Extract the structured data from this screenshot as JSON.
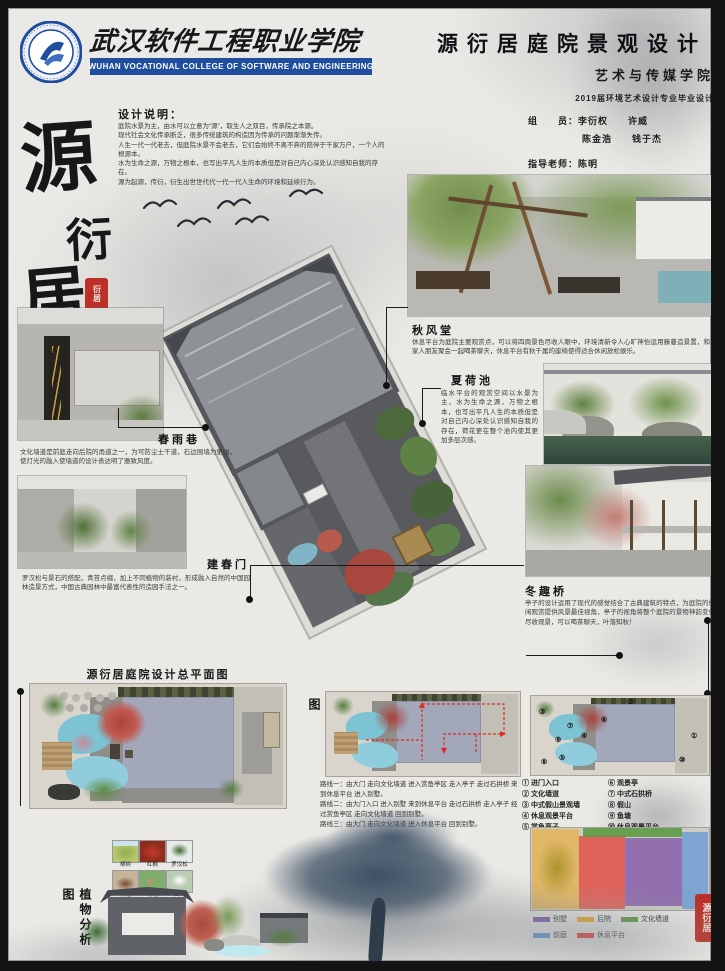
{
  "colors": {
    "brand_blue": "#1f4e9e",
    "seal_red": "#bc3027",
    "paper": "#ebe9e5"
  },
  "header": {
    "college_cn": "武汉软件工程职业学院",
    "college_en": "WUHAN VOCATIONAL COLLEGE OF SOFTWARE AND ENGINEERING",
    "poster_title": "源衍居庭院景观设计",
    "department": "艺术与传媒学院",
    "program": "2019届环境艺术设计专业毕业设计",
    "team_label": "组　　员：",
    "team_row1": "李衍权　　许威",
    "team_row2": "陈金浩　　钱于杰",
    "advisor_label": "指导老师：",
    "advisor_name": "陈明"
  },
  "design_note": {
    "title": "设计说明：",
    "lines": [
      "庭院水景为主，由水可以立意为“源”，取生人之双目，传承院之本源。",
      "现代社会文化传承断乏，很多传统建筑的构造因为传承的问题渐渐失传。",
      "人生一代一代老去，但庭院水景不会老去，它们会始终不离不弃的陪伴于千家万户，一个人的根源本。",
      "水为生命之源，万物之根本，也写出平凡人生的本质但是对自己内心深处认识感知自我的存在。",
      "源为起源，传衍，衍生出世世代代一代一代人生命的环境和延续行为。"
    ]
  },
  "calligraphy": {
    "char1": "源",
    "char2": "衍",
    "char3": "居",
    "seal_text": "衍居"
  },
  "features": [
    {
      "label": "秋风堂",
      "desc": "休息平台为庭院主要观赏点，可以将四周景色尽收人眼中，环境清新令人心旷神怡运用藤蔓造景置，和家人朋友聚会一起喝茶聊天，休息平台有秋千属的座椅使得适合休闲放松娱乐。"
    },
    {
      "label": "夏荷池",
      "desc": "临水平台的观赏空间以水景为主，水为生命之源，万物之根本，也写出平凡人生的本质但是对自己内心深处认识感知自我的存在，荷花更在整个池内使其更加多层次感。"
    },
    {
      "label": "春雨巷",
      "desc": "文化墙道是前庭走向后院的甬道之一，为可防尘土干道，石边围墙为更幽，使灯光的融入使墙道的设计表达明了雅致风度。"
    },
    {
      "label": "建春门",
      "desc": "罗汉松与景石的搭配，青苔点缀，加上不同植物的装衬，形成融入自然的中国园林造景方式，中国古典园林中最富代表性的造园手法之一。"
    },
    {
      "label": "冬趣桥",
      "desc": "亭子的设计运用了现代的感觉结合了古典建筑的特点，为庭院的休闲观赏提供风景最佳视角，亭子的视角将整个庭院的景物神韵变化尽收观景，可以喝茶聊天，叶落知秋！"
    }
  ],
  "bottom": {
    "master_title": "源衍居庭院设计总平面图",
    "route_title": "路线规划图",
    "route_lines": [
      "路线一：由大门 走向文化墙道 进入赏鱼亭区 走入亭子 走过石拱桥 来到休息平台 进入别墅。",
      "路线二：由大门入口 进入别墅 来到休息平台 走过石拱桥 走入亭子 经过赏鱼亭区 走向文化墙道 回到别墅。",
      "路线三：由大门 走向文化墙道 进入休息平台 回到别墅。"
    ],
    "legend_col1": [
      "① 进门入口",
      "② 文化墙道",
      "③ 中式假山景观墙",
      "④ 休息观景平台",
      "⑤ 赏鱼亭子"
    ],
    "legend_col2": [
      "⑥ 观景亭",
      "⑦ 中式石拱桥",
      "⑧ 假山",
      "⑨ 鱼塘",
      "⑩ 休息观景平台"
    ],
    "marks": [
      "①",
      "②",
      "③",
      "④",
      "⑤",
      "⑥",
      "⑦",
      "⑧",
      "⑨",
      "⑩"
    ],
    "zones": [
      {
        "label": "别墅",
        "color": "#7d50a8"
      },
      {
        "label": "后院",
        "color": "#f0a81c"
      },
      {
        "label": "文化墙道",
        "color": "#57963c"
      },
      {
        "label": "前庭",
        "color": "#5b93d8"
      },
      {
        "label": "休息平台",
        "color": "#e8231a"
      }
    ],
    "plants_title": "植物分析图",
    "plant_labels": [
      "柳树",
      "红枫",
      "罗汉松",
      "梅花",
      "荷花",
      "白梅"
    ],
    "seal2_text": "源衍居"
  }
}
